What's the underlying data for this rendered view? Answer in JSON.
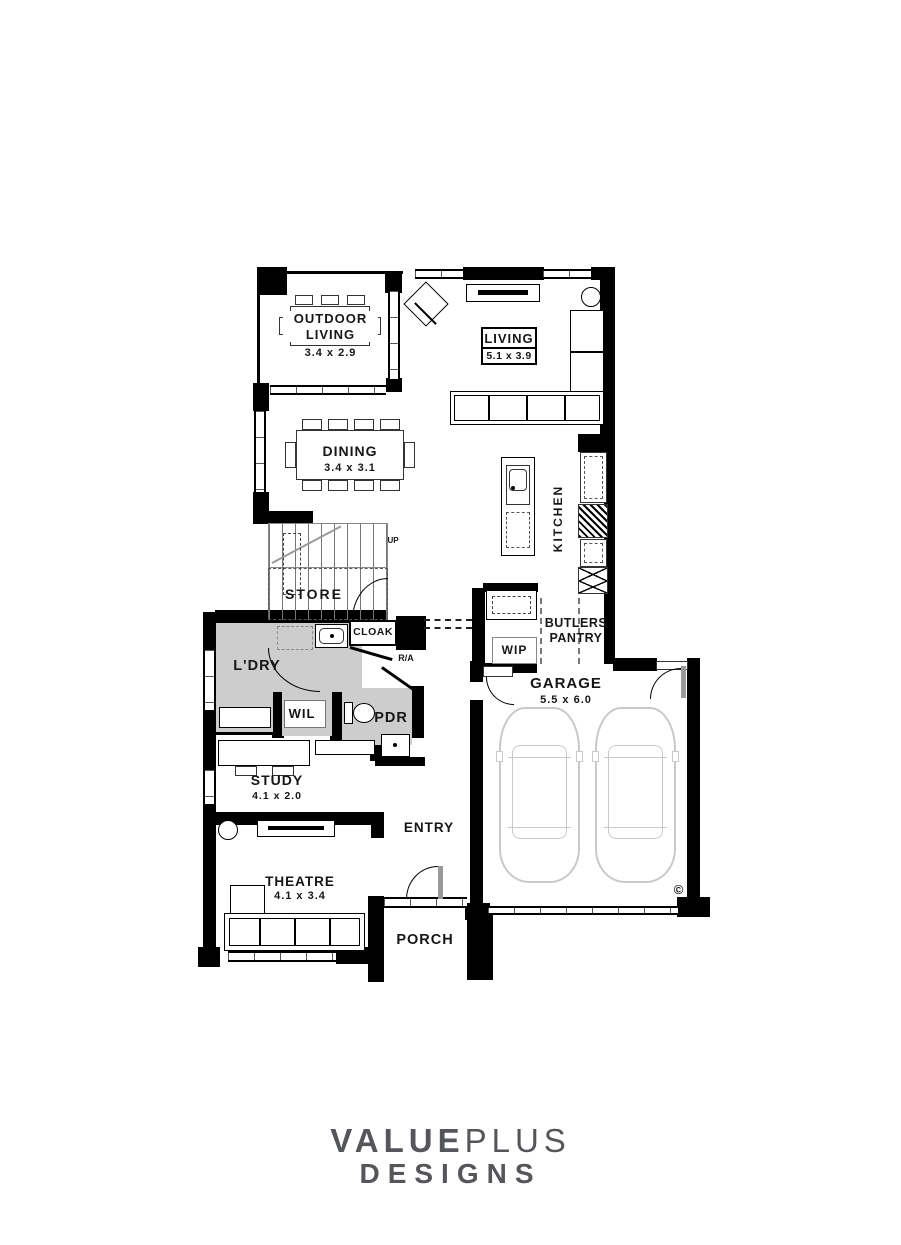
{
  "plan": {
    "rooms": {
      "outdoor_living": {
        "name": "OUTDOOR LIVING",
        "dims": "3.4 x 2.9"
      },
      "living": {
        "name": "LIVING",
        "dims": "5.1 x 3.9"
      },
      "dining": {
        "name": "DINING",
        "dims": "3.4 x 3.1"
      },
      "kitchen": {
        "name": "KITCHEN"
      },
      "store": {
        "name": "STORE"
      },
      "stairs": {
        "direction": "UP"
      },
      "cloak": {
        "name": "CLOAK"
      },
      "laundry": {
        "name": "L'DRY"
      },
      "wil": {
        "name": "WIL"
      },
      "powder": {
        "name": "PDR"
      },
      "return_air": {
        "name": "R/A"
      },
      "butlers_pantry": {
        "name": "BUTLERS PANTRY"
      },
      "wip": {
        "name": "WIP"
      },
      "garage": {
        "name": "GARAGE",
        "dims": "5.5 x 6.0"
      },
      "study": {
        "name": "STUDY",
        "dims": "4.1 x 2.0"
      },
      "entry": {
        "name": "ENTRY"
      },
      "theatre": {
        "name": "THEATRE",
        "dims": "4.1 x 3.4"
      },
      "porch": {
        "name": "PORCH"
      }
    },
    "copyright": "©"
  },
  "branding": {
    "value": "VALUE",
    "plus": "PLUS",
    "designs": "DESIGNS"
  },
  "colors": {
    "wall": "#000000",
    "wet_area_shade": "#cdcdcd",
    "car_outline": "#c9c9c9",
    "logo": "#54565a"
  }
}
